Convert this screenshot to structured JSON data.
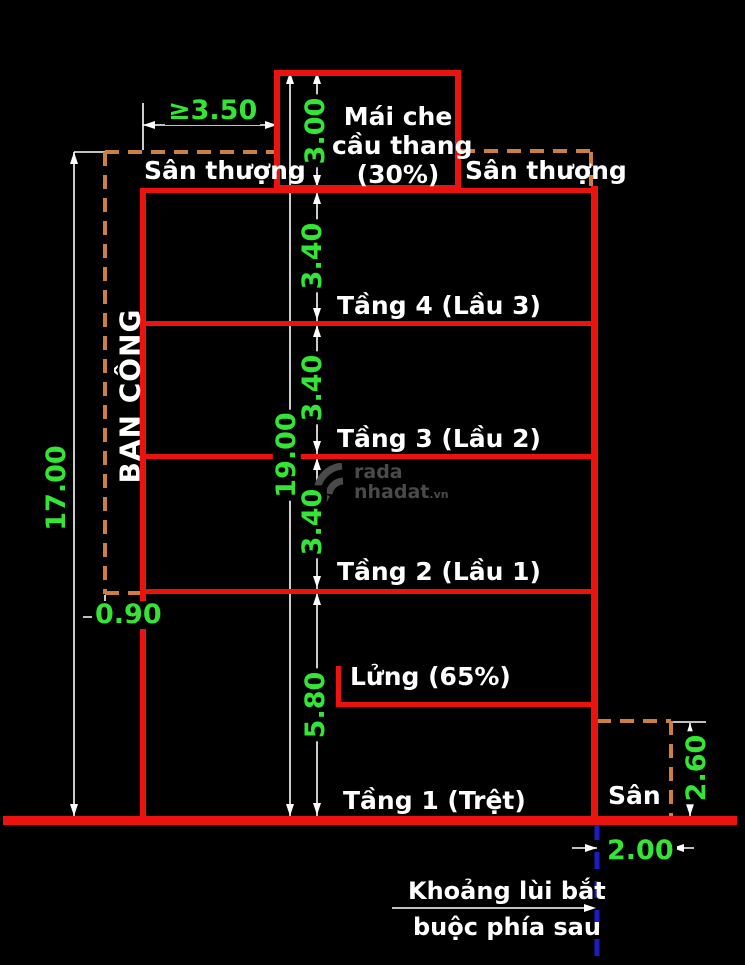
{
  "page": {
    "background": "#000000"
  },
  "watermark": {
    "brand_top": "rada",
    "brand_bottom": "nhadat",
    "brand_tld": ".vn"
  },
  "building": {
    "roof_label_line1": "Mái che",
    "roof_label_line2": "cầu thang",
    "roof_label_line3": "(30%)",
    "terrace_left": "Sân thượng",
    "terrace_right": "Sân thượng",
    "floor4": "Tầng 4 (Lầu 3)",
    "floor3": "Tầng 3 (Lầu 2)",
    "floor2": "Tầng 2 (Lầu 1)",
    "mezzanine": "Lửng (65%)",
    "floor1": "Tầng 1 (Trệt)",
    "yard": "Sân",
    "balcony": "BAN CÔNG",
    "rear_setback_note_line1": "Khoảng lùi bắt",
    "rear_setback_note_line2": "buộc phía sau"
  },
  "dimensions": {
    "roof_width_min": "≥3.50",
    "roof_height": "3.00",
    "overall_height": "17.00",
    "total_height_with_roof": "19.00",
    "floor4_height": "3.40",
    "floor3_height": "3.40",
    "floor2_height": "3.40",
    "ground_floor_height": "5.80",
    "balcony_depth": "0.90",
    "rear_block_height": "2.60",
    "rear_setback_depth": "2.00"
  },
  "colors": {
    "line_red": "#ea1310",
    "dim_green": "#35e535",
    "dash_orange": "#cc7f42",
    "setback_blue": "#1c1cc2",
    "text_white": "#ffffff",
    "watermark_gray": "#4a4a4a"
  }
}
